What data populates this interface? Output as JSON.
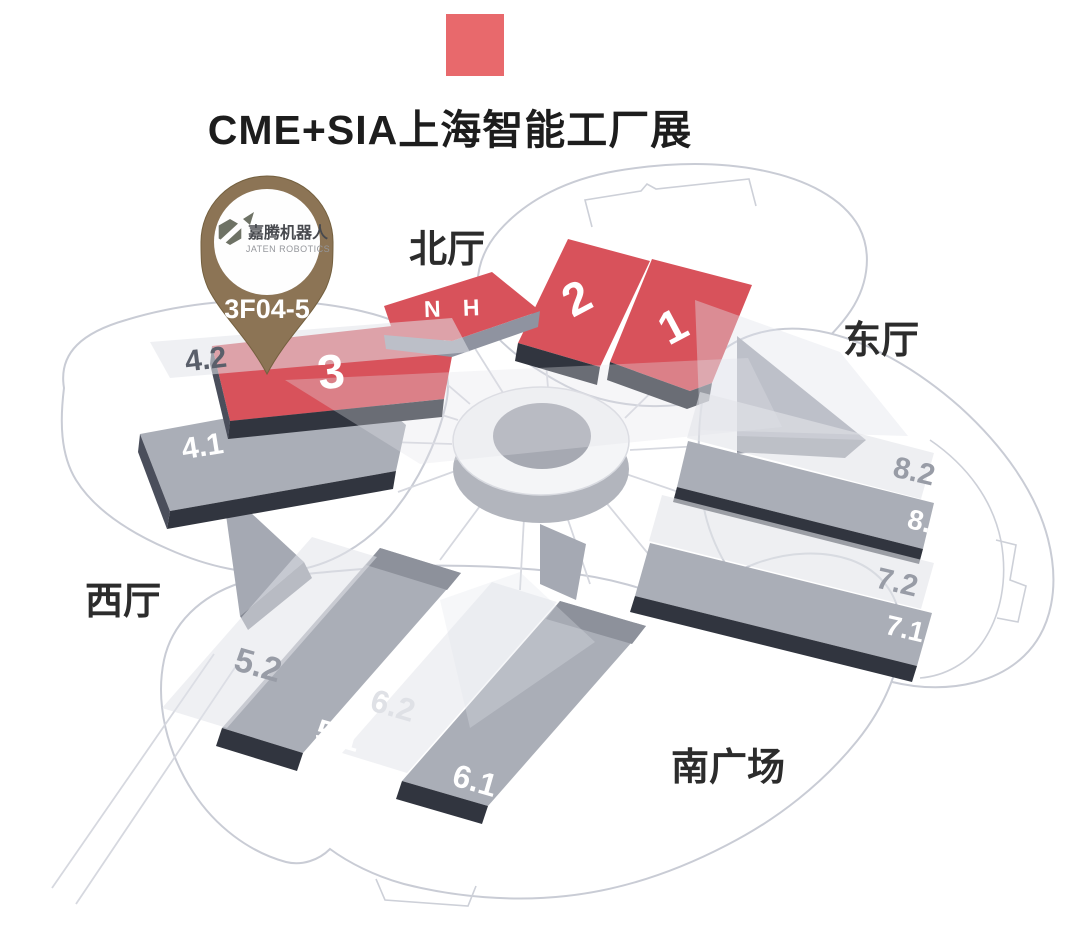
{
  "header": {
    "title": "CME+SIA上海智能工厂展",
    "accent_color": "#e8696c"
  },
  "pin": {
    "brand_cn": "嘉腾机器人",
    "brand_en": "JATEN ROBOTICS",
    "booth": "3F04-5",
    "body_color": "#8c7455"
  },
  "map": {
    "area_labels": {
      "north": "北厅",
      "east": "东厅",
      "west": "西厅",
      "south_plaza": "南广场"
    },
    "halls": [
      {
        "id": "2",
        "label": "2",
        "hall_type": "red"
      },
      {
        "id": "1",
        "label": "1",
        "hall_type": "red"
      },
      {
        "id": "NH",
        "label": "N H",
        "hall_type": "red"
      },
      {
        "id": "3",
        "label": "3",
        "hall_type": "red"
      },
      {
        "id": "4.2",
        "label": "4.2",
        "hall_type": "overlay"
      },
      {
        "id": "4.1",
        "label": "4.1",
        "hall_type": "gray"
      },
      {
        "id": "8.2",
        "label": "8.2",
        "hall_type": "overlay"
      },
      {
        "id": "8.1",
        "label": "8.1",
        "hall_type": "gray"
      },
      {
        "id": "7.2",
        "label": "7.2",
        "hall_type": "overlay"
      },
      {
        "id": "7.1",
        "label": "7.1",
        "hall_type": "gray"
      },
      {
        "id": "5.2",
        "label": "5.2",
        "hall_type": "overlay"
      },
      {
        "id": "5.1",
        "label": "5.1",
        "hall_type": "gray"
      },
      {
        "id": "6.2",
        "label": "6.2",
        "hall_type": "overlay"
      },
      {
        "id": "6.1",
        "label": "6.1",
        "hall_type": "gray"
      }
    ],
    "colors": {
      "hall_red": "#d8525b",
      "hall_gray": "#aaaeb7",
      "edge_dark": "#31353f",
      "outline": "#c9ccd5"
    }
  }
}
